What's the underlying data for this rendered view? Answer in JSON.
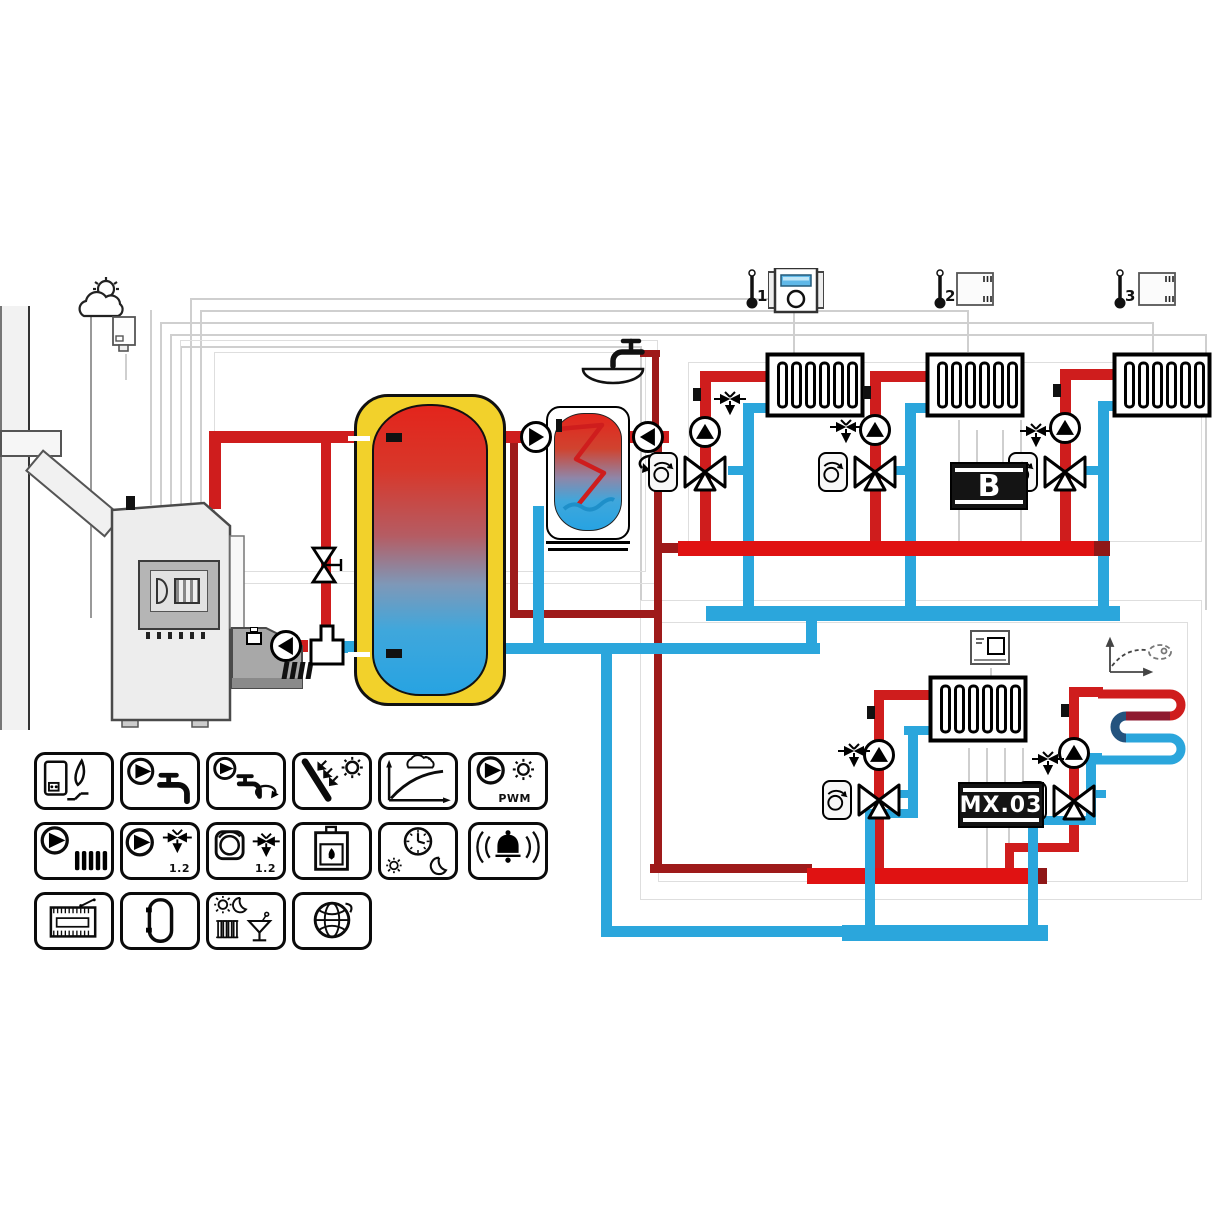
{
  "diagram": {
    "room_units": [
      {
        "label": "1"
      },
      {
        "label": "2"
      },
      {
        "label": "3"
      }
    ],
    "modules": {
      "zone_module_label": "B",
      "mixing_module_label": "MX.03"
    },
    "colors": {
      "hot": "#cf1d1d",
      "hot_bright": "#e01212",
      "hot_dark": "#9e1a1a",
      "cold": "#2ba6dc",
      "tank_jacket": "#f2d12b",
      "tank_hot": "#e3251c",
      "tank_cold": "#27a3e2"
    },
    "legend": {
      "rows": [
        [
          {
            "name": "boiler-burner"
          },
          {
            "name": "dhw-pump"
          },
          {
            "name": "dhw-circulation-pump"
          },
          {
            "name": "solar-collector"
          },
          {
            "name": "heating-curve"
          },
          {
            "name": "pwm-pump",
            "label": "PWM"
          }
        ],
        [
          {
            "name": "heating-circuit-pump"
          },
          {
            "name": "mixing-valve-pump",
            "label": "1.2"
          },
          {
            "name": "thermostat-mixing-valve",
            "label": "1.2"
          },
          {
            "name": "solid-fuel-boiler"
          },
          {
            "name": "day-night-program"
          },
          {
            "name": "alarm"
          }
        ],
        [
          {
            "name": "terminal-module"
          },
          {
            "name": "storage-tank"
          },
          {
            "name": "holiday-mode"
          },
          {
            "name": "internet-connection"
          }
        ]
      ]
    }
  }
}
